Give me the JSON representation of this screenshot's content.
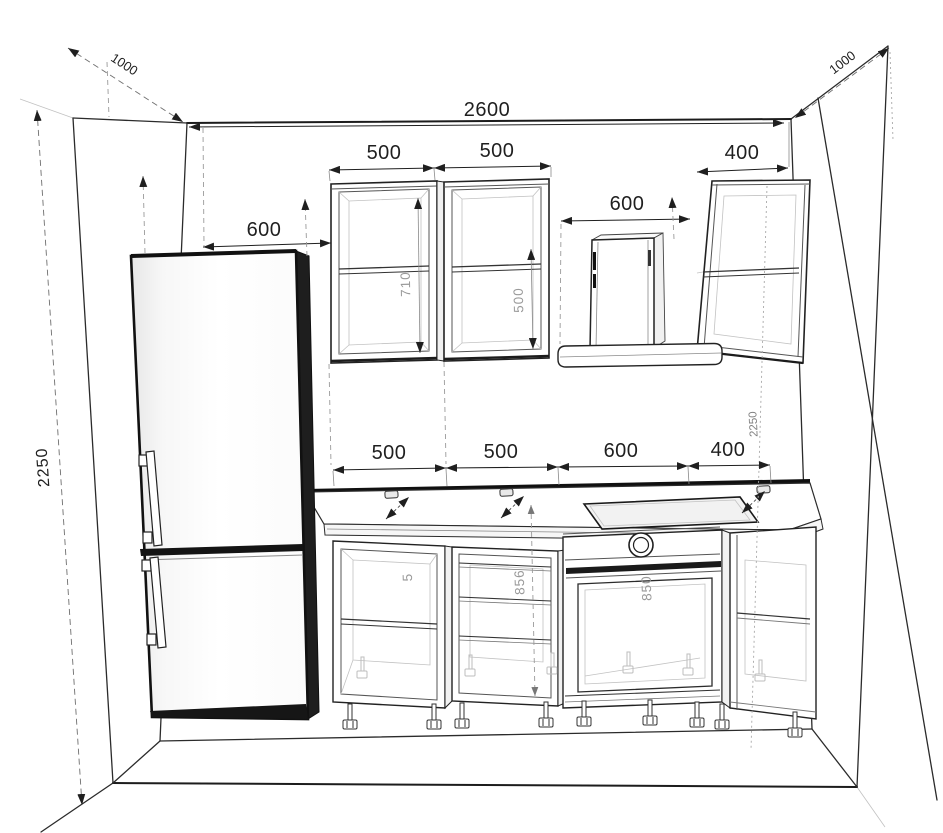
{
  "drawing": {
    "kind": "kitchen-elevation-perspective-wireframe",
    "colors": {
      "line": "#1f1f1f",
      "faint_line": "#c2c2c2",
      "muted_text": "#9a9a9a",
      "dark_accent": "#141414",
      "background": "#ffffff"
    },
    "labels": {
      "depth_left": "1000",
      "depth_right": "1000",
      "width_total": "2600",
      "height_left": "2250",
      "height_right": "2250",
      "fridge_gap": "600",
      "upper_row": {
        "cab1": "500",
        "cab2": "500",
        "hood_gap": "600",
        "cab3": "400"
      },
      "upper_heights": {
        "cab1": "710",
        "cab2": "500"
      },
      "base_row": {
        "cab1": "500",
        "cab2": "500",
        "cab3": "600",
        "cab4": "400"
      },
      "base_heights": {
        "cab1_partial": "5",
        "cab2": "856",
        "oven": "850"
      }
    }
  }
}
